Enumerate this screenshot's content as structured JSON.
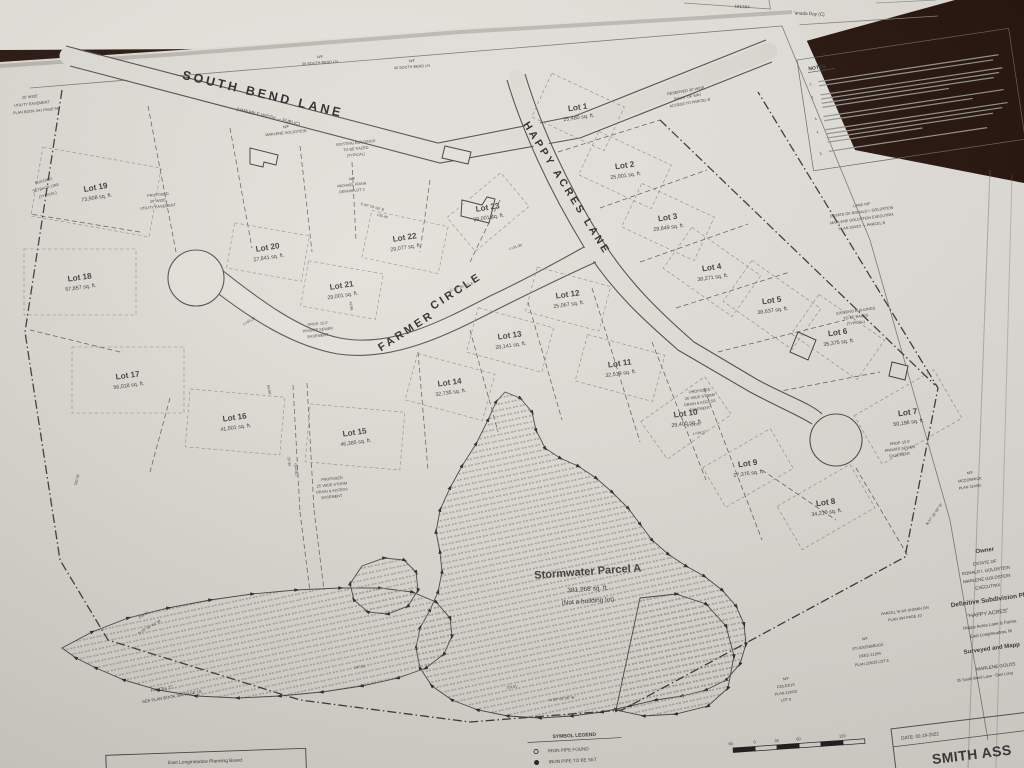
{
  "top_paper": {
    "page_number": "181/184",
    "label": "Canada Day (C)"
  },
  "plan": {
    "streets": [
      {
        "name": "SOUTH BEND LANE",
        "sub": "(VARIABLE WIDTH — PUBLIC)"
      },
      {
        "name": "HAPPY ACRES LANE"
      },
      {
        "name": "FARMER CIRCLE",
        "part1": "FARMER",
        "part2": "CIRCLE"
      }
    ],
    "notes_title": "NOTES",
    "notes": [
      {
        "n": "1.",
        "lines": [
          182,
          176
        ]
      },
      {
        "n": "2.",
        "lines": [
          184,
          180,
          174,
          128
        ]
      },
      {
        "n": "3.",
        "lines": [
          182,
          150
        ]
      },
      {
        "n": "4.",
        "lines": [
          184,
          178,
          168,
          96
        ]
      },
      {
        "n": "5.",
        "lines": [
          160
        ]
      }
    ],
    "lots": [
      {
        "num": "Lot 1",
        "area": "25,480 sq. ft.",
        "x": 578,
        "y": 110,
        "rot": -8,
        "brot": 25,
        "bw": 80,
        "bh": 48
      },
      {
        "num": "Lot 2",
        "area": "25,001 sq. ft.",
        "x": 625,
        "y": 168,
        "rot": -8,
        "brot": 25,
        "bw": 80,
        "bh": 48
      },
      {
        "num": "Lot 3",
        "area": "29,849 sq. ft.",
        "x": 668,
        "y": 220,
        "rot": -8,
        "brot": 25,
        "bw": 80,
        "bh": 48
      },
      {
        "num": "Lot 4",
        "area": "38,271 sq. ft.",
        "x": 712,
        "y": 270,
        "rot": -8,
        "brot": 35,
        "bw": 84,
        "bh": 50
      },
      {
        "num": "Lot 5",
        "area": "38,637 sq. ft.",
        "x": 772,
        "y": 303,
        "rot": -8,
        "brot": 35,
        "bw": 84,
        "bh": 50
      },
      {
        "num": "Lot 6",
        "area": "35,375 sq. ft.",
        "x": 838,
        "y": 335,
        "rot": -8,
        "brot": 35,
        "bw": 80,
        "bh": 48
      },
      {
        "num": "Lot 7",
        "area": "50,196 sq. ft.",
        "x": 908,
        "y": 415,
        "rot": -8,
        "brot": -30,
        "bw": 92,
        "bh": 56
      },
      {
        "num": "Lot 8",
        "area": "34,210 sq. ft.",
        "x": 826,
        "y": 505,
        "rot": -8,
        "brot": -30,
        "bw": 84,
        "bh": 50
      },
      {
        "num": "Lot 9",
        "area": "27,376 sq. ft.",
        "x": 748,
        "y": 466,
        "rot": -8,
        "brot": -30,
        "bw": 78,
        "bh": 46
      },
      {
        "num": "Lot 10",
        "area": "29,400 sq. ft.",
        "x": 686,
        "y": 416,
        "rot": -8,
        "brot": -35,
        "bw": 78,
        "bh": 46
      },
      {
        "num": "Lot 11",
        "area": "32,519 sq. ft.",
        "x": 620,
        "y": 366,
        "rot": -8,
        "brot": 15,
        "bw": 80,
        "bh": 48
      },
      {
        "num": "Lot 12",
        "area": "25,067 sq. ft.",
        "x": 568,
        "y": 297,
        "rot": -8,
        "brot": 15,
        "bw": 76,
        "bh": 46
      },
      {
        "num": "Lot 13",
        "area": "28,141 sq. ft.",
        "x": 510,
        "y": 338,
        "rot": -8,
        "brot": 15,
        "bw": 78,
        "bh": 46
      },
      {
        "num": "Lot 14",
        "area": "32,735 sq. ft.",
        "x": 450,
        "y": 385,
        "rot": -8,
        "brot": 15,
        "bw": 80,
        "bh": 48
      },
      {
        "num": "Lot 15",
        "area": "46,385 sq. ft.",
        "x": 355,
        "y": 435,
        "rot": -8,
        "brot": 5,
        "bw": 95,
        "bh": 58
      },
      {
        "num": "Lot 16",
        "area": "41,501 sq. ft.",
        "x": 235,
        "y": 420,
        "rot": -8,
        "brot": 5,
        "bw": 95,
        "bh": 58
      },
      {
        "num": "Lot 17",
        "area": "56,018 sq. ft.",
        "x": 128,
        "y": 378,
        "rot": -8,
        "brot": 0,
        "bw": 112,
        "bh": 66
      },
      {
        "num": "Lot 18",
        "area": "57,857 sq. ft.",
        "x": 80,
        "y": 280,
        "rot": -8,
        "brot": 0,
        "bw": 112,
        "bh": 66
      },
      {
        "num": "Lot 19",
        "area": "73,908 sq. ft.",
        "x": 96,
        "y": 190,
        "rot": -10,
        "brot": 10,
        "bw": 120,
        "bh": 70
      },
      {
        "num": "Lot 20",
        "area": "27,841 sq. ft.",
        "x": 268,
        "y": 250,
        "rot": -9,
        "brot": 10,
        "bw": 76,
        "bh": 46
      },
      {
        "num": "Lot 21",
        "area": "29,001 sq. ft.",
        "x": 342,
        "y": 288,
        "rot": -9,
        "brot": 10,
        "bw": 76,
        "bh": 46
      },
      {
        "num": "Lot 22",
        "area": "29,077 sq. ft.",
        "x": 405,
        "y": 240,
        "rot": -9,
        "brot": 12,
        "bw": 78,
        "bh": 48
      },
      {
        "num": "Lot 23",
        "area": "29,001 sq. ft.",
        "x": 488,
        "y": 210,
        "rot": -9,
        "brot": -40,
        "bw": 70,
        "bh": 44
      }
    ],
    "stormwater_parcel": {
      "name": "Stormwater Parcel A",
      "area": "381,268 sq. ft.",
      "note": "(Not a building lot)"
    },
    "annotations": [
      {
        "t": "N/F",
        "x": 320,
        "y": 58,
        "r": -4
      },
      {
        "t": "30 SOUTH BEND LN",
        "x": 320,
        "y": 64,
        "r": -4
      },
      {
        "t": "N/F",
        "x": 412,
        "y": 62,
        "r": -4
      },
      {
        "t": "40 SOUTH BEND LN",
        "x": 412,
        "y": 68,
        "r": -4
      },
      {
        "t": "N/F",
        "x": 286,
        "y": 128,
        "r": -6
      },
      {
        "t": "MARLENE GOLDSTEIN",
        "x": 286,
        "y": 134,
        "r": -6
      },
      {
        "t": "EXISTING BUILDINGS",
        "x": 356,
        "y": 144,
        "r": -6
      },
      {
        "t": "TO BE RAZED",
        "x": 356,
        "y": 150,
        "r": -6
      },
      {
        "t": "(TYPICAL)",
        "x": 356,
        "y": 156,
        "r": -6
      },
      {
        "t": "N/F",
        "x": 352,
        "y": 180,
        "r": -6
      },
      {
        "t": "MICHAEL FRAIN",
        "x": 352,
        "y": 186,
        "r": -6
      },
      {
        "t": "DENNIS LOT 2",
        "x": 352,
        "y": 192,
        "r": -6
      },
      {
        "t": "RESERVED 30' WIDE",
        "x": 686,
        "y": 92,
        "r": -10
      },
      {
        "t": "RIGHT OF WAY",
        "x": 688,
        "y": 98,
        "r": -10
      },
      {
        "t": "ACCESS TO PARCEL B",
        "x": 690,
        "y": 104,
        "r": -10
      },
      {
        "t": "BUILDING",
        "x": 44,
        "y": 182,
        "r": -15
      },
      {
        "t": "SETBACK LINE",
        "x": 46,
        "y": 189,
        "r": -15
      },
      {
        "t": "(TYPICAL)",
        "x": 48,
        "y": 196,
        "r": -15
      },
      {
        "t": "25' WIDE",
        "x": 30,
        "y": 98,
        "r": -6
      },
      {
        "t": "UTILITY EASEMENT",
        "x": 32,
        "y": 105,
        "r": -6
      },
      {
        "t": "PLAN BOOK 341 PAGE 94",
        "x": 36,
        "y": 112,
        "r": -6
      },
      {
        "t": "PROPOSED",
        "x": 158,
        "y": 196,
        "r": -6
      },
      {
        "t": "20' WIDE",
        "x": 158,
        "y": 202,
        "r": -6
      },
      {
        "t": "UTILITY EASEMENT",
        "x": 158,
        "y": 208,
        "r": -6
      },
      {
        "t": "PROP. 15.0'",
        "x": 318,
        "y": 325,
        "r": -6
      },
      {
        "t": "PRIVATE SEWER",
        "x": 318,
        "y": 331,
        "r": -6
      },
      {
        "t": "EASEMENT",
        "x": 318,
        "y": 337,
        "r": -6
      },
      {
        "t": "PROP. 15.0'",
        "x": 900,
        "y": 444,
        "r": -8
      },
      {
        "t": "PRIVATE SEWER",
        "x": 900,
        "y": 450,
        "r": -8
      },
      {
        "t": "EASEMENT",
        "x": 900,
        "y": 456,
        "r": -8
      },
      {
        "t": "PROPOSED",
        "x": 332,
        "y": 480,
        "r": -6
      },
      {
        "t": "25' WIDE STORM",
        "x": 332,
        "y": 486,
        "r": -6
      },
      {
        "t": "DRAIN & ACCESS",
        "x": 332,
        "y": 492,
        "r": -6
      },
      {
        "t": "EASEMENT",
        "x": 332,
        "y": 498,
        "r": -6
      },
      {
        "t": "PROPOSED",
        "x": 700,
        "y": 392,
        "r": -8
      },
      {
        "t": "25' WIDE STORM",
        "x": 700,
        "y": 398,
        "r": -8
      },
      {
        "t": "DRAIN & ACCESS",
        "x": 700,
        "y": 404,
        "r": -8
      },
      {
        "t": "EASEMENT",
        "x": 700,
        "y": 410,
        "r": -8
      },
      {
        "t": "EXISTING BUILDINGS",
        "x": 856,
        "y": 312,
        "r": -8
      },
      {
        "t": "TO BE RAZED",
        "x": 856,
        "y": 318,
        "r": -8
      },
      {
        "t": "(TYPICAL)",
        "x": 856,
        "y": 324,
        "r": -8
      },
      {
        "t": "LAND N/F",
        "x": 862,
        "y": 206,
        "r": -8
      },
      {
        "t": "ESTATE OF RONALD I. GOLDSTEIN",
        "x": 862,
        "y": 213,
        "r": -8
      },
      {
        "t": "MARLENE GOLDSTEIN EXECUTRIX",
        "x": 862,
        "y": 220,
        "r": -8
      },
      {
        "t": "PLAN 294/10 — PARCEL B",
        "x": 862,
        "y": 227,
        "r": -8
      },
      {
        "t": "PARCEL 'C'",
        "x": 162,
        "y": 690,
        "r": -10,
        "s": 4.2
      },
      {
        "t": "SEE PLAN BOOK 394 PAGE 10",
        "x": 172,
        "y": 698,
        "r": -10,
        "s": 4.2
      },
      {
        "t": "N/F",
        "x": 865,
        "y": 640,
        "r": -8
      },
      {
        "t": "STUCKENBRUCK",
        "x": 868,
        "y": 648,
        "r": -8
      },
      {
        "t": "DEED 21264",
        "x": 870,
        "y": 656,
        "r": -8
      },
      {
        "t": "PLAN 226/25 LOT 8",
        "x": 872,
        "y": 664,
        "r": -8
      },
      {
        "t": "N/F",
        "x": 786,
        "y": 680,
        "r": -8
      },
      {
        "t": "COLEZUS",
        "x": 786,
        "y": 687,
        "r": -8
      },
      {
        "t": "PLAN 226/25",
        "x": 786,
        "y": 694,
        "r": -8
      },
      {
        "t": "LOT 8",
        "x": 786,
        "y": 701,
        "r": -8
      },
      {
        "t": "N/F",
        "x": 970,
        "y": 474,
        "r": -8
      },
      {
        "t": "MCCORMICK",
        "x": 970,
        "y": 481,
        "r": -8
      },
      {
        "t": "PLAN 324/92",
        "x": 970,
        "y": 488,
        "r": -8
      },
      {
        "t": "PARCEL 'B' AS SHOWN ON",
        "x": 905,
        "y": 612,
        "r": -8
      },
      {
        "t": "PLAN 394 PAGE 10",
        "x": 905,
        "y": 619,
        "r": -8
      }
    ],
    "dims": [
      {
        "t": "S 40° 29' 06\" E",
        "x": 372,
        "y": 208,
        "r": 15
      },
      {
        "t": "135.44",
        "x": 382,
        "y": 217,
        "r": 15
      },
      {
        "t": "L=31.09'",
        "x": 516,
        "y": 248,
        "r": -18
      },
      {
        "t": "R=25.00'",
        "x": 694,
        "y": 426,
        "r": -8
      },
      {
        "t": "L=39.27'",
        "x": 700,
        "y": 434,
        "r": -8
      },
      {
        "t": "43.86",
        "x": 350,
        "y": 306,
        "r": 80
      },
      {
        "t": "723.51'",
        "x": 512,
        "y": 688,
        "r": -7
      },
      {
        "t": "N 54° 04' 06\" W",
        "x": 562,
        "y": 700,
        "r": -7
      },
      {
        "t": "N 25° 52' 41\" W",
        "x": 150,
        "y": 628,
        "r": -30
      },
      {
        "t": "208.02",
        "x": 144,
        "y": 616,
        "r": -30
      },
      {
        "t": "147.31'",
        "x": 360,
        "y": 668,
        "r": -8
      },
      {
        "t": "25.35'",
        "x": 288,
        "y": 462,
        "r": 85
      },
      {
        "t": "(EASE.)",
        "x": 295,
        "y": 470,
        "r": 85
      },
      {
        "t": "292.02",
        "x": 78,
        "y": 480,
        "r": -75
      },
      {
        "t": "L=43.25'",
        "x": 250,
        "y": 322,
        "r": -30
      },
      {
        "t": "S 36° 20' 42\" E",
        "x": 462,
        "y": 288,
        "r": -18
      },
      {
        "t": "63.00'",
        "x": 268,
        "y": 390,
        "r": 80
      },
      {
        "t": "N 57° 32' 06\" W",
        "x": 935,
        "y": 515,
        "r": -55
      }
    ],
    "legend": {
      "title": "SYMBOL LEGEND",
      "items": [
        {
          "icon": "iron-pipe-found-icon",
          "symbol": "open-circle",
          "label": "IRON PIPE FOUND"
        },
        {
          "icon": "iron-pipe-to-be-set-icon",
          "symbol": "filled-circle",
          "label": "IRON PIPE TO BE SET"
        }
      ]
    },
    "owner_block": {
      "lines": [
        {
          "t": "Owner",
          "x": 985,
          "y": 552,
          "s": 6,
          "b": 1
        },
        {
          "t": "ESTATE OF",
          "x": 985,
          "y": 564,
          "s": 4.4
        },
        {
          "t": "RONALD I. GOLDSTEIN",
          "x": 986,
          "y": 572,
          "s": 4.4
        },
        {
          "t": "MARLENE GOLDSTEIN",
          "x": 987,
          "y": 580,
          "s": 4.4
        },
        {
          "t": "EXECUTRIX",
          "x": 988,
          "y": 588,
          "s": 4.4
        },
        {
          "t": "Definitive Subdivision Pl",
          "x": 988,
          "y": 602,
          "s": 6.4,
          "b": 1
        },
        {
          "t": "\"HAPPY ACRES\"",
          "x": 988,
          "y": 615,
          "s": 5.4
        },
        {
          "t": "Happy Acres Lane & Farme",
          "x": 990,
          "y": 626,
          "s": 4.4
        },
        {
          "t": "East Longmeadow, M",
          "x": 991,
          "y": 635,
          "s": 4.4
        },
        {
          "t": "Surveyed and Mapp",
          "x": 992,
          "y": 650,
          "s": 6,
          "b": 1
        },
        {
          "t": "MARLENE GOLDS",
          "x": 996,
          "y": 668,
          "s": 4.6
        },
        {
          "t": "35 South Bend Lane - East Long",
          "x": 985,
          "y": 678,
          "s": 3.9
        }
      ]
    },
    "planning_board": "East Longmeadow Planning Board",
    "title_block": {
      "date": "DATE: 02-19-2022",
      "firm": "SMITH ASS"
    },
    "scale_ticks": [
      "60",
      "0",
      "30",
      "60",
      "120"
    ]
  }
}
